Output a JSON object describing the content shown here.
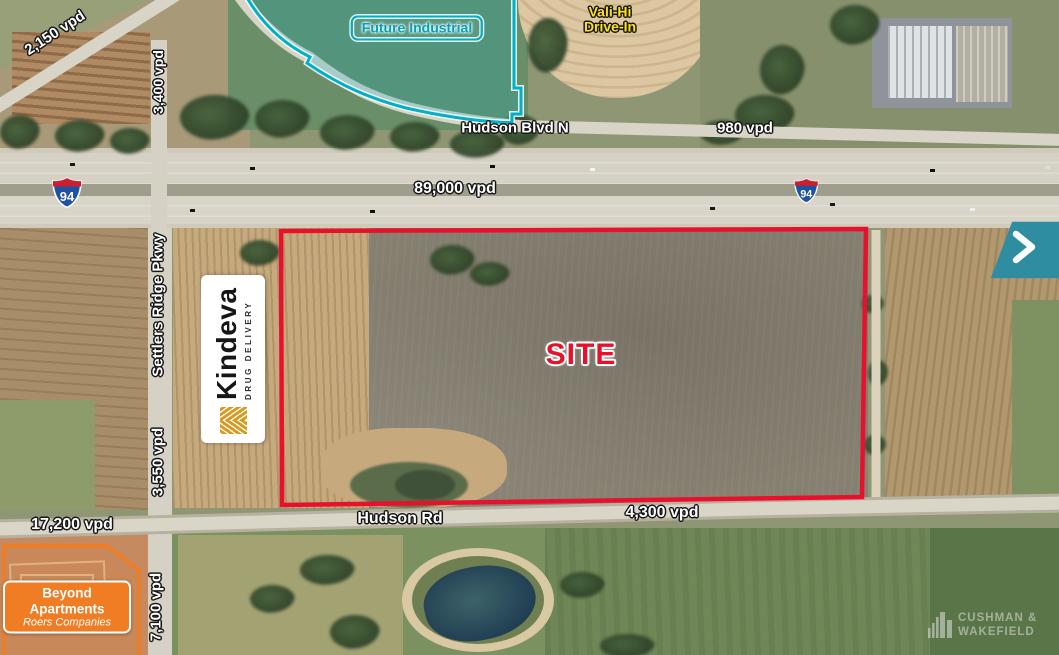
{
  "map": {
    "site": {
      "label": "SITE",
      "boundary_color": "#E8112D"
    },
    "zones": {
      "future_industrial": {
        "label": "Future Industrial",
        "color": "#00AEC6"
      },
      "beyond_apartments": {
        "name": "Beyond Apartments",
        "company": "Roers Companies",
        "color": "#F07D24"
      }
    },
    "poi": {
      "vali_hi": {
        "line1": "Vali-Hi",
        "line2": "Drive-In",
        "color": "#FFE11A"
      }
    },
    "roads": {
      "hudson_blvd_n": "Hudson Blvd N",
      "hudson_rd": "Hudson Rd",
      "settlers_ridge_pkwy": "Settlers Ridge Pkwy",
      "interstate_route": "94"
    },
    "traffic_counts": {
      "i94": "89,000 vpd",
      "hudson_blvd_n_east": "980 vpd",
      "county_rd_nw": "2,150 vpd",
      "settlers_ridge_north": "3,400 vpd",
      "settlers_ridge_mid": "3,550 vpd",
      "settlers_ridge_south": "7,100 vpd",
      "hudson_rd_west": "17,200 vpd",
      "hudson_rd_east": "4,300 vpd"
    },
    "logos": {
      "kindeva": {
        "name": "Kindeva",
        "tagline": "DRUG DELIVERY"
      },
      "cushman_wakefield": {
        "line1": "CUSHMAN &",
        "line2": "WAKEFIELD"
      }
    }
  }
}
